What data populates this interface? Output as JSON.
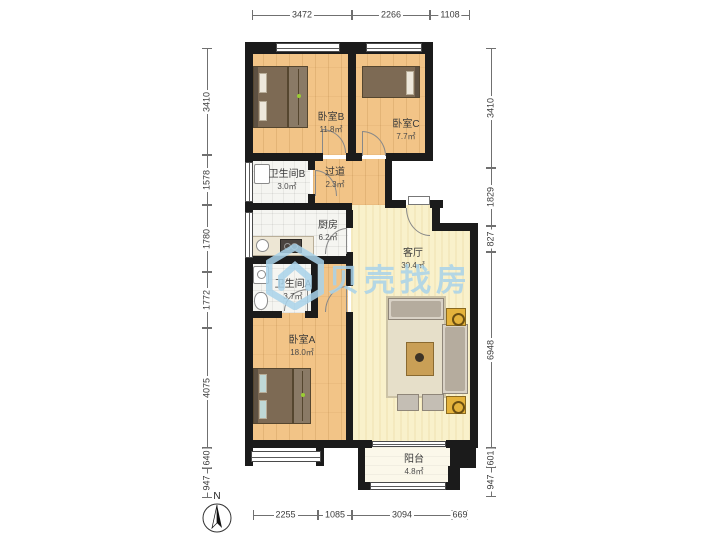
{
  "watermark": {
    "brand": "贝壳找房",
    "color": "#A9D3EA"
  },
  "compass": {
    "label": "N"
  },
  "rooms": {
    "bedroom_b": {
      "name": "卧室B",
      "area": "11.8㎡"
    },
    "bedroom_c": {
      "name": "卧室C",
      "area": "7.7㎡"
    },
    "bathroom_b": {
      "name": "卫生间B",
      "area": "3.0㎡"
    },
    "hallway": {
      "name": "过道",
      "area": "2.3㎡"
    },
    "kitchen": {
      "name": "厨房",
      "area": "6.2㎡"
    },
    "bathroom_a": {
      "name": "卫生间A",
      "area": "3.7㎡"
    },
    "bedroom_a": {
      "name": "卧室A",
      "area": "18.0㎡"
    },
    "living_room": {
      "name": "客厅",
      "area": "30.4㎡"
    },
    "balcony": {
      "name": "阳台",
      "area": "4.8㎡"
    }
  },
  "dimensions_mm": {
    "top": [
      "3472",
      "2266",
      "1108"
    ],
    "bottom": [
      "2255",
      "1085",
      "3094",
      "669"
    ],
    "left": [
      "3410",
      "1578",
      "1780",
      "1772",
      "4075",
      "640",
      "947"
    ],
    "right": [
      "3410",
      "1829",
      "827",
      "6948",
      "601",
      "947"
    ]
  },
  "colors": {
    "wall": "#1b1b1b",
    "wood_floor": "#F2C487",
    "living_floor": "#F9F1CB",
    "tile_floor": "#F5F5F1",
    "watermark_blue": "#A9D3EA"
  }
}
